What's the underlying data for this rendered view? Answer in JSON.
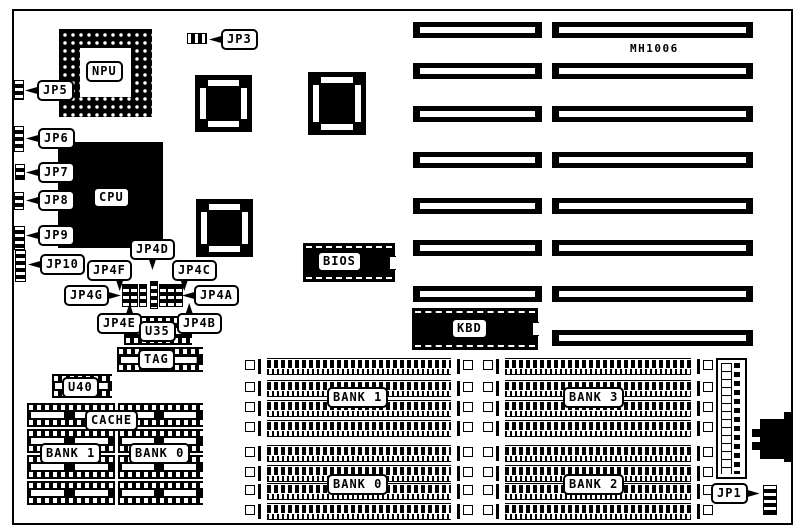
{
  "figure": {
    "type": "motherboard layout diagram",
    "model_number": "MH1006"
  },
  "colors": {
    "ink": "#000000",
    "paper": "#ffffff"
  },
  "chips": {
    "npu": "NPU",
    "cpu": "CPU",
    "bios": "BIOS",
    "kbd": "KBD",
    "u35": "U35",
    "tag": "TAG",
    "u40": "U40",
    "cache": "CACHE"
  },
  "jumpers": {
    "jp1": "JP1",
    "jp3": "JP3",
    "jp5": "JP5",
    "jp6": "JP6",
    "jp7": "JP7",
    "jp8": "JP8",
    "jp9": "JP9",
    "jp10": "JP10",
    "jp4a": "JP4A",
    "jp4b": "JP4B",
    "jp4c": "JP4C",
    "jp4d": "JP4D",
    "jp4e": "JP4E",
    "jp4f": "JP4F",
    "jp4g": "JP4G"
  },
  "memory": {
    "cache_bank1": "BANK 1",
    "cache_bank0": "BANK 0",
    "simm_bank1": "BANK 1",
    "simm_bank0": "BANK 0",
    "simm_bank3": "BANK 3",
    "simm_bank2": "BANK 2"
  }
}
